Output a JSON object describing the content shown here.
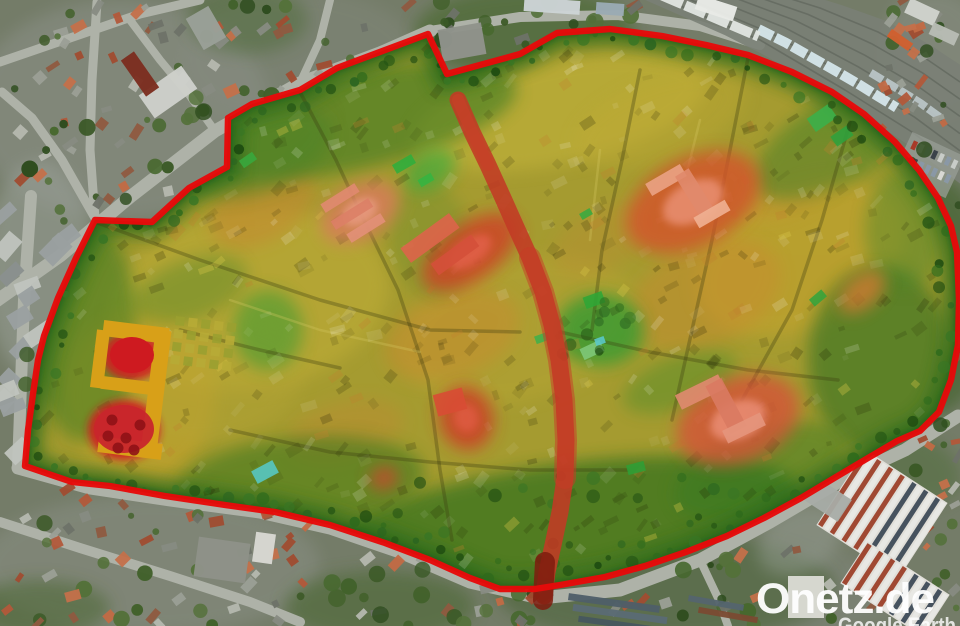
{
  "watermark": {
    "text": "Onetz.de",
    "attribution": "Google Earth"
  },
  "colors": {
    "base_outside": "#747c68",
    "town_base": "#a59b30",
    "boundary": "#e60a0a",
    "rim_green": "#2a6a1c",
    "rim_green_dark": "#1e5a14",
    "road": "#aeb2a8",
    "street_red": "#c23a24",
    "street_red_mid": "#c83a26",
    "street_red_dark": "#7e1c0e",
    "rail_band": "#7a8076",
    "rail_track": "#646a60"
  },
  "boundary_points": "300,90 337,68 428,34 447,74 520,54 557,33 610,29 662,36 706,45 748,55 792,72 832,92 864,114 895,142 919,170 938,198 951,226 957,252 959,300 958,345 951,380 939,412 920,431 897,441 868,458 836,477 801,498 764,518 727,536 686,552 645,566 605,577 560,585 535,589 500,589 470,578 430,560 385,543 330,525 275,512 225,505 165,496 110,486 72,482 25,466 28,430 33,394 38,360 44,336 58,298 76,258 95,220 152,222 189,188 227,167 228,118 252,104",
  "red_street": {
    "points": "458,100 472,132 488,165 503,198 515,225 530,258 543,292 552,325 559,360 564,400 566,440 565,478 560,512 553,545 547,572 544,596",
    "width": 17,
    "mid_points": "530,258 543,292 552,325 559,360 564,400 566,440 565,478",
    "mid_width": 22,
    "top_points": "458,100 472,132 488,165",
    "top_width": 12,
    "lower_points": "545,562 544,580 543,600",
    "lower_width": 20
  },
  "roads": [
    {
      "points": "-5,302 60,256 130,197 215,131 300,83 380,53 430,31",
      "width": 13
    },
    {
      "points": "430,31 520,17 618,15 700,26 760,45",
      "width": 10
    },
    {
      "points": "31,196 24,300 18,468",
      "width": 12
    },
    {
      "points": "18,468 90,488 170,500 260,512 330,528 400,552 470,582 540,598",
      "width": 13
    },
    {
      "points": "540,598 620,590 700,560 770,522 845,478 905,450 958,416",
      "width": 13
    },
    {
      "points": "95,218 62,160 32,118 2,92",
      "width": 9
    },
    {
      "points": "97,2 92,80 90,150 95,218",
      "width": 9
    },
    {
      "points": "0,62 70,38 140,14 200,0",
      "width": 9
    },
    {
      "points": "0,522 80,548 170,576 250,602 300,622",
      "width": 10
    },
    {
      "points": "700,560 718,598 728,626",
      "width": 8
    },
    {
      "points": "845,478 868,516 884,556 894,600",
      "width": 8
    },
    {
      "points": "215,131 190,96 160,60 130,20",
      "width": 8
    },
    {
      "points": "300,83 320,40 330,0",
      "width": 8
    }
  ],
  "railway": {
    "inner": [
      [
        648,
        -8
      ],
      [
        760,
        40
      ],
      [
        845,
        90
      ],
      [
        912,
        132
      ],
      [
        960,
        168
      ]
    ],
    "outer": [
      [
        756,
        -12
      ],
      [
        820,
        8
      ],
      [
        878,
        32
      ],
      [
        925,
        58
      ],
      [
        960,
        82
      ]
    ],
    "tracks": 6,
    "trains": [
      {
        "t": 0.18,
        "from": 0.22,
        "to": 0.68,
        "w": 10,
        "color": "#d5e6ea",
        "dash": "16 3"
      },
      {
        "t": 0.05,
        "from": 0.02,
        "to": 0.24,
        "w": 10,
        "color": "#e2e6e2",
        "dash": "22 3"
      },
      {
        "t": 0.42,
        "from": 0.55,
        "to": 0.88,
        "w": 8,
        "color": "#b9c4c6",
        "dash": "14 3"
      }
    ],
    "parking": {
      "x": 900,
      "y": 142,
      "w": 58,
      "h": 46,
      "rot": 25,
      "car_colors": [
        "#c8ccc8",
        "#3a424a",
        "#8a98a6",
        "#a83a28",
        "#d8d8d4"
      ]
    }
  },
  "factory": {
    "halls": [
      {
        "cx": 882,
        "cy": 514,
        "w": 98,
        "h": 90,
        "rot": 33
      },
      {
        "cx": 895,
        "cy": 589,
        "w": 98,
        "h": 50,
        "rot": 33
      }
    ],
    "stripe_red": "#a04832",
    "stripe_slate": "#46525e",
    "stripe_white": "#e8e8e4",
    "base": "#e0ded8",
    "extras": [
      [
        828,
        500,
        40,
        26,
        33,
        "#a8aca6"
      ],
      [
        806,
        597,
        36,
        42,
        0,
        "#dcdcd6"
      ]
    ]
  },
  "storage_rows": [
    [
      614,
      603,
      92,
      7,
      8,
      "#4e5e68"
    ],
    [
      620,
      614,
      95,
      7,
      8,
      "#5a6a74"
    ],
    [
      623,
      625,
      90,
      6,
      8,
      "#46565e"
    ],
    [
      716,
      603,
      56,
      6,
      10,
      "#54646e"
    ],
    [
      728,
      615,
      60,
      6,
      10,
      "#7a4a32"
    ]
  ],
  "misc_buildings": [
    [
      168,
      92,
      52,
      28,
      -35,
      "#cdd0ca"
    ],
    [
      140,
      74,
      16,
      44,
      -35,
      "#7c2e20"
    ],
    [
      206,
      28,
      26,
      36,
      -30,
      "#9aa098"
    ],
    [
      462,
      42,
      44,
      32,
      -10,
      "#8f938b"
    ],
    [
      552,
      6,
      56,
      14,
      4,
      "#ccd4d6"
    ],
    [
      610,
      9,
      28,
      12,
      4,
      "#9aaab4"
    ],
    [
      716,
      8,
      40,
      15,
      18,
      "#e8eae6"
    ],
    [
      900,
      40,
      26,
      9,
      35,
      "#cf6030"
    ],
    [
      922,
      12,
      32,
      16,
      25,
      "#cfd3cc"
    ],
    [
      944,
      34,
      28,
      13,
      25,
      "#b8bcb4"
    ],
    [
      222,
      560,
      52,
      40,
      8,
      "#8e9288"
    ],
    [
      264,
      548,
      20,
      30,
      8,
      "#d8d8d2"
    ]
  ],
  "patches_outside": [
    [
      120,
      110,
      150,
      110,
      0,
      "#8e938b",
      0.5
    ],
    [
      40,
      270,
      55,
      110,
      0,
      "#9aa098",
      0.55
    ],
    [
      300,
      60,
      120,
      70,
      0,
      "#878c82",
      0.35
    ],
    [
      150,
      565,
      170,
      70,
      0,
      "#8d9289",
      0.45
    ],
    [
      715,
      595,
      190,
      50,
      0,
      "#838982",
      0.4
    ],
    [
      935,
      55,
      55,
      65,
      0,
      "#8f948c",
      0.45
    ],
    [
      525,
      32,
      110,
      45,
      0,
      "#4c6a31",
      0.7
    ],
    [
      935,
      295,
      58,
      120,
      0,
      "#45642d",
      0.7
    ],
    [
      665,
      588,
      170,
      55,
      0,
      "#3f5d29",
      0.5
    ],
    [
      380,
      606,
      95,
      35,
      0,
      "#47662e",
      0.55
    ],
    [
      40,
      608,
      70,
      28,
      0,
      "#44632c",
      0.5
    ],
    [
      902,
      464,
      62,
      36,
      20,
      "#4a6a30",
      0.45
    ],
    [
      800,
      540,
      45,
      32,
      -30,
      "#9aa098",
      0.45
    ],
    [
      248,
      20,
      60,
      34,
      0,
      "#4a6930",
      0.45
    ]
  ],
  "town": {
    "patches": [
      [
        250,
        300,
        140,
        90,
        -10,
        "#c3b039",
        0.5
      ],
      [
        560,
        112,
        150,
        52,
        -12,
        "#c8b73d",
        0.5
      ],
      [
        800,
        258,
        110,
        70,
        -25,
        "#c8a42f",
        0.55
      ],
      [
        520,
        330,
        120,
        70,
        -15,
        "#bba735",
        0.4
      ],
      [
        140,
        395,
        75,
        85,
        0,
        "#cfa52a",
        0.45
      ],
      [
        210,
        380,
        95,
        60,
        -10,
        "#b4a434",
        0.45
      ],
      [
        660,
        120,
        90,
        40,
        -20,
        "#c0aa34",
        0.4
      ],
      [
        452,
        335,
        70,
        42,
        -20,
        "#c88b2e",
        0.5
      ],
      [
        705,
        295,
        80,
        50,
        -25,
        "#c88a2e",
        0.45
      ],
      [
        262,
        205,
        58,
        36,
        -30,
        "#c8822f",
        0.45
      ],
      [
        278,
        132,
        55,
        32,
        -25,
        "#c09038",
        0.45
      ],
      [
        345,
        432,
        60,
        30,
        -15,
        "#bf8930",
        0.4
      ],
      [
        795,
        180,
        62,
        30,
        -30,
        "#c59030",
        0.4
      ],
      [
        600,
        240,
        52,
        30,
        -30,
        "#bc8b30",
        0.35
      ],
      [
        350,
        122,
        170,
        48,
        -12,
        "#3a7a22",
        0.6
      ],
      [
        255,
        152,
        80,
        40,
        -20,
        "#458427",
        0.5
      ],
      [
        560,
        522,
        240,
        58,
        -8,
        "#2e6f1e",
        0.7
      ],
      [
        300,
        482,
        125,
        45,
        -5,
        "#34741f",
        0.55
      ],
      [
        85,
        330,
        52,
        112,
        0,
        "#3a7a22",
        0.55
      ],
      [
        880,
        360,
        72,
        95,
        0,
        "#2e6f20",
        0.6
      ],
      [
        600,
        330,
        44,
        36,
        0,
        "#2f9a30",
        0.75
      ],
      [
        840,
        140,
        95,
        42,
        -30,
        "#3e8026",
        0.5
      ],
      [
        760,
        470,
        90,
        40,
        -20,
        "#357a22",
        0.5
      ],
      [
        430,
        240,
        40,
        60,
        -10,
        "#5c8a2c",
        0.3
      ],
      [
        190,
        290,
        60,
        30,
        -20,
        "#4c8428",
        0.4
      ],
      [
        680,
        382,
        60,
        26,
        -20,
        "#3f8a28",
        0.4
      ],
      [
        905,
        230,
        40,
        60,
        0,
        "#49862b",
        0.45
      ],
      [
        268,
        330,
        35,
        40,
        0,
        "#2f9a30",
        0.5
      ],
      [
        430,
        170,
        28,
        18,
        -30,
        "#2fae3c",
        0.6
      ]
    ],
    "hotspots": [
      [
        470,
        252,
        55,
        28,
        -35,
        "#cf3f27",
        "#e2604a"
      ],
      [
        693,
        202,
        72,
        44,
        -28,
        "#d4532c",
        "#e98f72"
      ],
      [
        738,
        420,
        64,
        42,
        -22,
        "#d45238",
        "#ea8d74"
      ],
      [
        360,
        212,
        42,
        27,
        -30,
        "#d97a5c",
        "#e89a80"
      ],
      [
        466,
        418,
        27,
        32,
        -15,
        "#ce3a26",
        "#df5b42"
      ],
      [
        384,
        478,
        14,
        11,
        -20,
        "#cb442f",
        null
      ],
      [
        862,
        292,
        27,
        16,
        -40,
        "#ce7a30",
        null
      ]
    ],
    "accents": [
      [
        700,
        392,
        48,
        16,
        -26,
        "#e08a70"
      ],
      [
        726,
        406,
        54,
        18,
        62,
        "#d97a62"
      ],
      [
        744,
        428,
        42,
        14,
        -26,
        "#e4957c"
      ],
      [
        666,
        180,
        40,
        14,
        -30,
        "#eaa284"
      ],
      [
        694,
        192,
        46,
        16,
        58,
        "#e08a6c"
      ],
      [
        712,
        214,
        36,
        12,
        -30,
        "#efb092"
      ],
      [
        430,
        238,
        60,
        18,
        -36,
        "#dd644a"
      ],
      [
        455,
        255,
        50,
        14,
        -36,
        "#d4503a"
      ],
      [
        340,
        198,
        40,
        10,
        -32,
        "#e08a70"
      ],
      [
        352,
        214,
        44,
        10,
        -32,
        "#db8066"
      ],
      [
        366,
        228,
        40,
        10,
        -32,
        "#e29078"
      ],
      [
        450,
        402,
        30,
        22,
        -15,
        "#d84c34"
      ]
    ],
    "green_buildings": [
      [
        404,
        164,
        22,
        10,
        -30,
        "#2fae3c"
      ],
      [
        426,
        180,
        15,
        8,
        -30,
        "#35b441"
      ],
      [
        594,
        300,
        20,
        12,
        -20,
        "#2fa636"
      ],
      [
        248,
        160,
        16,
        9,
        -35,
        "#38a83e"
      ],
      [
        636,
        468,
        18,
        10,
        -15,
        "#2f9e35"
      ],
      [
        818,
        298,
        16,
        9,
        -40,
        "#34a43c"
      ],
      [
        542,
        338,
        14,
        8,
        -20,
        "#40b04a"
      ],
      [
        586,
        214,
        12,
        7,
        -30,
        "#38aa40"
      ],
      [
        822,
        118,
        26,
        16,
        -35,
        "#3ab04a"
      ],
      [
        842,
        136,
        20,
        12,
        -35,
        "#2fa03c"
      ],
      [
        592,
        350,
        22,
        12,
        -25,
        "#7fc87a"
      ]
    ],
    "cyan_buildings": [
      [
        265,
        472,
        24,
        14,
        -28,
        "#56c6c2"
      ],
      [
        600,
        341,
        10,
        7,
        -20,
        "#5ac8c8"
      ]
    ],
    "street_shadows": [
      "95,222 200,260 320,300 430,330 520,332",
      "300,92 336,160 360,212 398,290 428,380 440,470 452,540",
      "640,70 622,160 602,250 592,330",
      "748,58 730,150 712,240 692,330 672,420",
      "850,122 822,220 792,310 742,400",
      "230,430 330,452 430,462 530,470 628,470",
      "560,332 650,352 748,370 838,380",
      "180,330 260,350 340,368"
    ],
    "street_lights": [
      "230,300 320,330 420,352",
      "600,150 590,240",
      "700,120 680,200"
    ],
    "castle": {
      "wings": [
        [
          136,
          332,
          66,
          16,
          7
        ],
        [
          156,
          392,
          16,
          124,
          7
        ],
        [
          131,
          386,
          60,
          13,
          7
        ],
        [
          130,
          448,
          64,
          16,
          7
        ],
        [
          100,
          359,
          13,
          58,
          7
        ]
      ],
      "color": "#d8a018",
      "glow": [
        [
          132,
          356,
          30,
          24
        ],
        [
          124,
          430,
          36,
          30
        ]
      ],
      "glow_color": "#d01a20",
      "court": [
        132,
        355,
        22,
        18
      ],
      "court_color": "#ce1a20",
      "garden": [
        124,
        429,
        30,
        24
      ],
      "garden_color": "#c8262c",
      "tree_color": "#8f1216",
      "garden_trees": [
        [
          112,
          420
        ],
        [
          126,
          438
        ],
        [
          140,
          425
        ],
        [
          118,
          448
        ],
        [
          134,
          450
        ],
        [
          108,
          436
        ]
      ],
      "parterre": {
        "x": 176,
        "y": 316,
        "rows": 4,
        "cols": 5,
        "size": 9,
        "gap": 4,
        "rot": 7,
        "colors": [
          "#9aa030",
          "#b7ab36"
        ]
      }
    }
  },
  "scatter_regions": [
    {
      "x": 0,
      "y": 0,
      "w": 430,
      "h": 210,
      "count": 130,
      "tree_ratio": 0.35
    },
    {
      "x": 0,
      "y": 196,
      "w": 68,
      "h": 274,
      "count": 22,
      "tree_ratio": 0.1,
      "gray": true
    },
    {
      "x": 0,
      "y": 470,
      "w": 330,
      "h": 156,
      "count": 70,
      "tree_ratio": 0.3
    },
    {
      "x": 330,
      "y": 545,
      "w": 230,
      "h": 81,
      "count": 34,
      "tree_ratio": 0.55
    },
    {
      "x": 600,
      "y": 545,
      "w": 360,
      "h": 81,
      "count": 40,
      "tree_ratio": 0.45
    },
    {
      "x": 880,
      "y": 0,
      "w": 80,
      "h": 130,
      "count": 26,
      "tree_ratio": 0.3
    },
    {
      "x": 898,
      "y": 140,
      "w": 62,
      "h": 290,
      "count": 40,
      "tree_ratio": 0.7
    },
    {
      "x": 430,
      "y": 0,
      "w": 220,
      "h": 60,
      "count": 30,
      "tree_ratio": 0.75
    },
    {
      "x": 912,
      "y": 430,
      "w": 48,
      "h": 120,
      "count": 14,
      "tree_ratio": 0.3
    }
  ],
  "roof_palette": [
    "#b2593a",
    "#c26a45",
    "#a04c30",
    "#8f5a40",
    "#9b9f96",
    "#b5b8af",
    "#878b82",
    "#6e7268",
    "#c4704a"
  ],
  "gray_palette": [
    "#9aa0a0",
    "#aab0ac",
    "#8a908e",
    "#c0c4be"
  ],
  "tree_palette": [
    "#3b5926",
    "#47682e",
    "#2f4d1f",
    "#54713a",
    "#42612b"
  ],
  "town_tree_palette": [
    "#245414",
    "#2e6a1c",
    "#1c4a10",
    "#387524",
    "#2a6420"
  ]
}
